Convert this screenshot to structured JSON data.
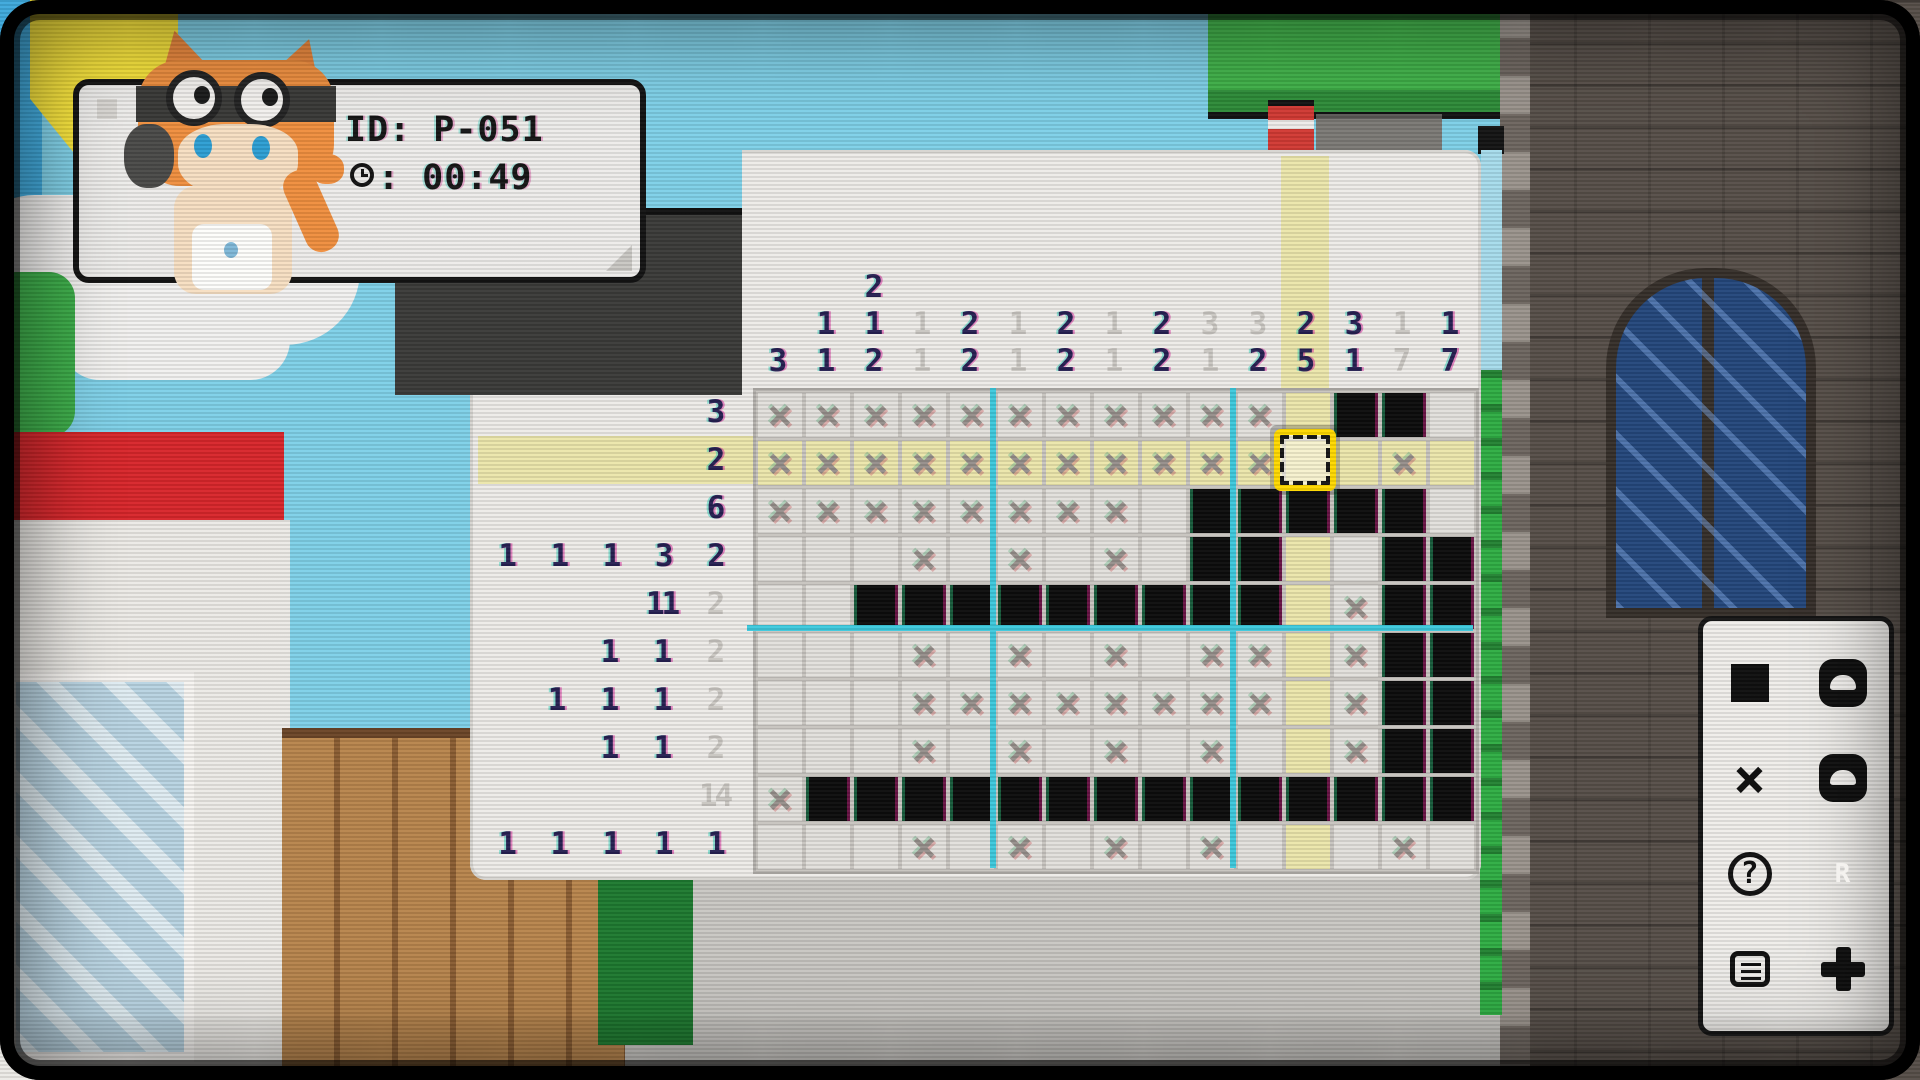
{
  "hud": {
    "id_line": "ID: P-051",
    "time_line": ": 00:49"
  },
  "puzzle": {
    "grid_cols": 15,
    "grid_rows": 10,
    "cell_size": 48,
    "grid_left": 753,
    "grid_top": 388,
    "cursor": {
      "row": 2,
      "col": 12
    },
    "guide_every": 5,
    "cells": [
      "xxxxxxxxxxx.bb.",
      "xxxxxxxxxxx..x.",
      "xxxxxxxx.bbbbb.",
      "...x.x.x.bb..bb",
      "..bbbbbbbbb.xbb",
      "...x.x.x.xx.xbb",
      "...xxxxxxxx.xbb",
      "...x.x.x.x..xbb",
      "xbbbbbbbbbbbbbb",
      "...x.x.x.x...x."
    ],
    "column_hints": [
      [
        {
          "t": "3",
          "f": false
        }
      ],
      [
        {
          "t": "1",
          "f": false
        },
        {
          "t": "1",
          "f": false
        }
      ],
      [
        {
          "t": "2",
          "f": false
        },
        {
          "t": "1",
          "f": false
        },
        {
          "t": "2",
          "f": false
        }
      ],
      [
        {
          "t": "1",
          "f": true
        },
        {
          "t": "1",
          "f": true
        }
      ],
      [
        {
          "t": "2",
          "f": false
        },
        {
          "t": "2",
          "f": false
        }
      ],
      [
        {
          "t": "1",
          "f": true
        },
        {
          "t": "1",
          "f": true
        }
      ],
      [
        {
          "t": "2",
          "f": false
        },
        {
          "t": "2",
          "f": false
        }
      ],
      [
        {
          "t": "1",
          "f": true
        },
        {
          "t": "1",
          "f": true
        }
      ],
      [
        {
          "t": "2",
          "f": false
        },
        {
          "t": "2",
          "f": false
        }
      ],
      [
        {
          "t": "3",
          "f": true
        },
        {
          "t": "1",
          "f": true
        }
      ],
      [
        {
          "t": "3",
          "f": true
        },
        {
          "t": "2",
          "f": false
        }
      ],
      [
        {
          "t": "2",
          "f": false
        },
        {
          "t": "5",
          "f": false
        }
      ],
      [
        {
          "t": "3",
          "f": false
        },
        {
          "t": "1",
          "f": false
        }
      ],
      [
        {
          "t": "1",
          "f": true
        },
        {
          "t": "7",
          "f": true
        }
      ],
      [
        {
          "t": "1",
          "f": false
        },
        {
          "t": "7",
          "f": false
        }
      ]
    ],
    "row_hints": [
      [
        {
          "t": "3",
          "f": false
        }
      ],
      [
        {
          "t": "2",
          "f": false
        }
      ],
      [
        {
          "t": "6",
          "f": false
        }
      ],
      [
        {
          "t": "1",
          "f": false
        },
        {
          "t": "1",
          "f": false
        },
        {
          "t": "1",
          "f": false
        },
        {
          "t": "3",
          "f": false
        },
        {
          "t": "2",
          "f": false
        }
      ],
      [
        {
          "t": "11",
          "f": false
        },
        {
          "t": "2",
          "f": true
        }
      ],
      [
        {
          "t": "1",
          "f": false
        },
        {
          "t": "1",
          "f": false
        },
        {
          "t": "2",
          "f": true
        }
      ],
      [
        {
          "t": "1",
          "f": false
        },
        {
          "t": "1",
          "f": false
        },
        {
          "t": "1",
          "f": false
        },
        {
          "t": "2",
          "f": true
        }
      ],
      [
        {
          "t": "1",
          "f": false
        },
        {
          "t": "1",
          "f": false
        },
        {
          "t": "2",
          "f": true
        }
      ],
      [
        {
          "t": "14",
          "f": true
        }
      ],
      [
        {
          "t": "1",
          "f": false
        },
        {
          "t": "1",
          "f": false
        },
        {
          "t": "1",
          "f": false
        },
        {
          "t": "1",
          "f": false
        },
        {
          "t": "1",
          "f": false
        }
      ]
    ],
    "colors": {
      "panel": "#edebe8",
      "highlight": "#ebe6ab",
      "filled": "#0c0c0c",
      "guide": "#3ec9dd",
      "hint_bold": "#262052",
      "hint_faint": "#c9c6c1",
      "cursor_yellow": "#ffd900"
    }
  },
  "legend": {
    "rows": [
      {
        "left": {
          "icon": "fill-square"
        },
        "right": {
          "icon": "pad-button-a"
        }
      },
      {
        "left": {
          "icon": "x-mark",
          "glyph": "×"
        },
        "right": {
          "icon": "pad-button-b"
        }
      },
      {
        "left": {
          "icon": "help",
          "glyph": "?"
        },
        "right": {
          "icon": "pad-button-r",
          "glyph": "R"
        }
      },
      {
        "left": {
          "icon": "menu"
        },
        "right": {
          "icon": "pad-button-plus"
        }
      }
    ]
  }
}
